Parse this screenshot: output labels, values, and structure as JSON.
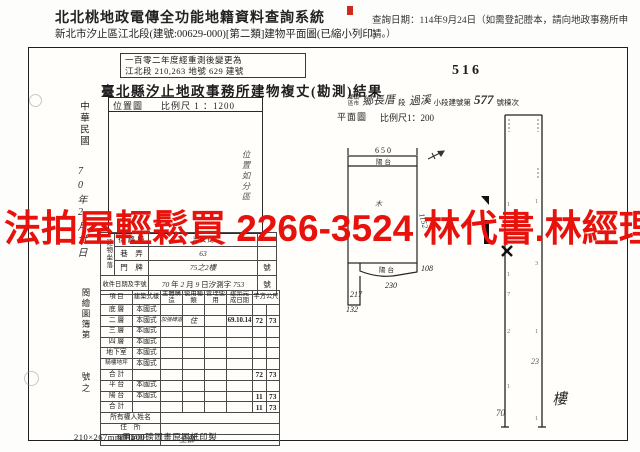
{
  "header": {
    "system_title": "北北桃地政電傳全功能地籍資料查詢系統",
    "query_note": "查詢日期：114年9月24日（如需登記謄本，請向地政事務所申請。）",
    "doc_subtitle": "新北市汐止區江北段(建號:00629-000)[第二類]建物平面圖(已縮小列印)"
  },
  "watermark": {
    "text": "法拍屋輕鬆買 2266-3524 林代書.林經理",
    "color": "#e8120c"
  },
  "sheet": {
    "remeasure_stamp_line1": "一百零二年度經重測後變更為",
    "remeasure_stamp_line2": "江北段 210,263 地號 629 建號",
    "title": "臺北縣汐止地政事務所建物複丈(勘測)結果",
    "page_no": "516",
    "margin": {
      "era": "中華民國",
      "handwritten_date": "70年2月廿日",
      "ledger_label": "閱繪圖簿第",
      "ledger_suffix": "號之"
    },
    "location_map": {
      "label": "位置圖",
      "scale": "比例尺 1 ：1200",
      "handwritten_note": "位置如分區"
    },
    "building_id_line": {
      "prefix_top": "鄉鎮",
      "prefix_bottom": "區市",
      "township_hw": "鄉長厝",
      "duan": "段",
      "xiaoduan_hw": "過溪",
      "mid": "小段建號第",
      "number_hw": "577",
      "suffix": "號棟次"
    },
    "floor_plan": {
      "label": "平面圖",
      "scale": "比例尺1：200",
      "balcony_top_label": "陽台",
      "balcony_bottom_label": "陽台",
      "dim_top": "650",
      "dim_right": "1152",
      "dim_108": "108",
      "dim_230": "230",
      "dim_217": "217",
      "dim_132": "132",
      "inner_mark": "木"
    },
    "address": {
      "group_label": "建物坐落",
      "rows": [
        {
          "label": "街 路 段",
          "value_hw": "吉安街",
          "suffix": ""
        },
        {
          "label": "巷　弄",
          "value_hw": "63",
          "suffix": ""
        },
        {
          "label": "門　牌",
          "value_hw": "75之2樓",
          "suffix": "號"
        }
      ],
      "receipt": {
        "label": "收件日期及字號",
        "year_hw": "70",
        "year_unit": "年",
        "month_hw": "2",
        "month_unit": "月",
        "day_hw": "9",
        "day_unit": "日汐測字",
        "number_hw": "753",
        "suffix": "號"
      }
    },
    "survey_table": {
      "headers": [
        "項 目",
        "建築式樣",
        "主體構造",
        "使用種類",
        "管理使用",
        "建築完成日期",
        "平方公尺"
      ],
      "rows": [
        {
          "label": "底 層",
          "style": "本國式",
          "structure": "",
          "use": "",
          "manage": "",
          "date": "",
          "a1": "",
          "a2": ""
        },
        {
          "label": "二 層",
          "style": "本國式",
          "structure": "加強磚造",
          "use": "住",
          "manage": "",
          "date": "69.10.14",
          "a1": "72",
          "a2": "73"
        },
        {
          "label": "三 層",
          "style": "本國式",
          "structure": "",
          "use": "",
          "manage": "",
          "date": "",
          "a1": "",
          "a2": ""
        },
        {
          "label": "四 層",
          "style": "本國式",
          "structure": "",
          "use": "",
          "manage": "",
          "date": "",
          "a1": "",
          "a2": ""
        },
        {
          "label": "地下室",
          "style": "本國式",
          "structure": "",
          "use": "",
          "manage": "",
          "date": "",
          "a1": "",
          "a2": ""
        },
        {
          "label": "騎樓地坪",
          "style": "本國式",
          "structure": "",
          "use": "",
          "manage": "",
          "date": "",
          "a1": "",
          "a2": ""
        },
        {
          "label": "合 計",
          "style": "",
          "structure": "",
          "use": "",
          "manage": "",
          "date": "",
          "a1": "72",
          "a2": "73"
        },
        {
          "label": "平 台",
          "style": "本國式",
          "structure": "",
          "use": "",
          "manage": "",
          "date": "",
          "a1": "",
          "a2": ""
        },
        {
          "label": "陽 台",
          "style": "本國式",
          "structure": "",
          "use": "",
          "manage": "",
          "date": "",
          "a1": "11",
          "a2": "73"
        },
        {
          "label": "合 計",
          "style": "",
          "structure": "",
          "use": "",
          "manage": "",
          "date": "",
          "a1": "11",
          "a2": "73"
        },
        {
          "label": "所有權人姓名",
          "value": ""
        },
        {
          "label": "住　所",
          "value": ""
        },
        {
          "label": "權利範圍",
          "value_hw": "全部"
        }
      ]
    },
    "right_sketch": {
      "left_nums": [
        "1",
        "1",
        "7",
        "2",
        "1"
      ],
      "right_nums": [
        "1",
        "3",
        "1",
        "1"
      ],
      "hw_23": "23",
      "hw_70": "70"
    },
    "floor_hw": "樓",
    "footer_note": "210×267mm用500磅圖畫原圖紙印製"
  }
}
